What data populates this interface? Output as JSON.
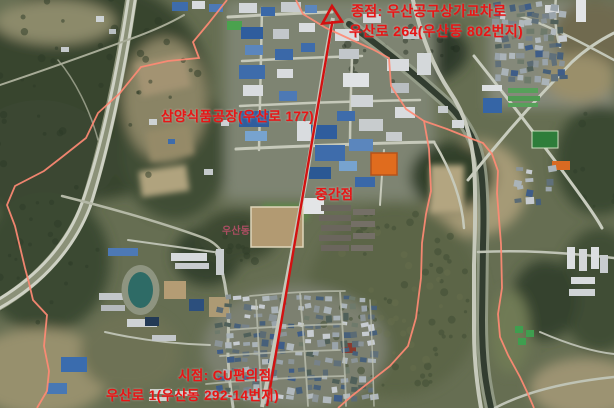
{
  "map": {
    "annotations": {
      "end": {
        "line1": "종점: 우산공구상가교차로",
        "line2": "우산로 264(우산동 802번지)"
      },
      "factory": "삼양식품공장(우산로 177)",
      "midpoint": "중간점",
      "district": "우산동",
      "start": {
        "line1": "시점: CU편의점",
        "line2": "우산로 1(우산동 292-14번지)"
      }
    },
    "colors": {
      "annotation_red": "#e81515",
      "route_red": "#d31111",
      "boundary_pink": "#ff8a74",
      "district_pink": "#bf4f6b"
    }
  }
}
